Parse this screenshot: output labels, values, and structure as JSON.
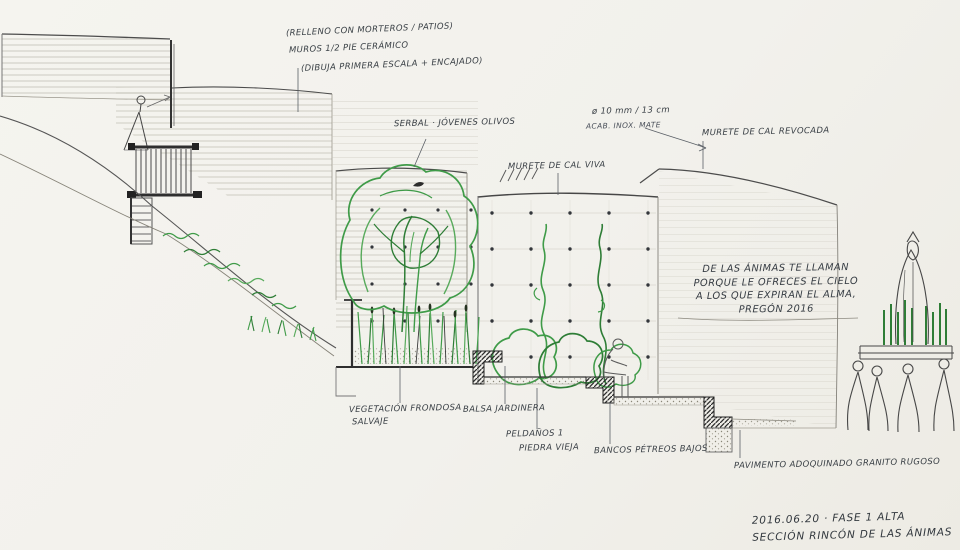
{
  "colors": {
    "paper": "#f2f1ec",
    "ink": "#3b4046",
    "vegetation": "#3f9b48",
    "cut_fill": "#2f2f2f"
  },
  "notes": {
    "line1": "(RELLENO CON MORTEROS / PATIOS)",
    "line2": "MUROS 1/2 PIE CERÁMICO",
    "line3": "(DIBUJA PRIMERA ESCALA + ENCAJADO)"
  },
  "labels": {
    "tree": "SERBAL · JÓVENES OLIVOS",
    "railing_spec": "ø 10 mm / 13 cm",
    "railing_finish": "ACAB. INOX. MATE",
    "wall_right": "MURETE DE CAL REVOCADA",
    "wall_center": "MURETE DE CAL VIVA",
    "veg_line1": "VEGETACIÓN FRONDOSA",
    "veg_line2": "SALVAJE",
    "planter": "BALSA JARDINERA",
    "steps_line1": "PELDAÑOS 1",
    "steps_line2": "PIEDRA VIEJA",
    "bench": "BANCOS PÉTREOS BAJOS",
    "paving": "PAVIMENTO ADOQUINADO GRANITO RUGOSO"
  },
  "quote": {
    "line1": "DE LAS ÁNIMAS TE LLAMAN",
    "line2": "PORQUE LE OFRECES EL CIELO",
    "line3": "A LOS QUE EXPIRAN EL ALMA,",
    "line4": "PREGÓN 2016"
  },
  "titleblock": {
    "line1": "2016.06.20 · FASE 1 ALTA",
    "line2": "SECCIÓN RINCÓN DE LAS ÁNIMAS"
  }
}
